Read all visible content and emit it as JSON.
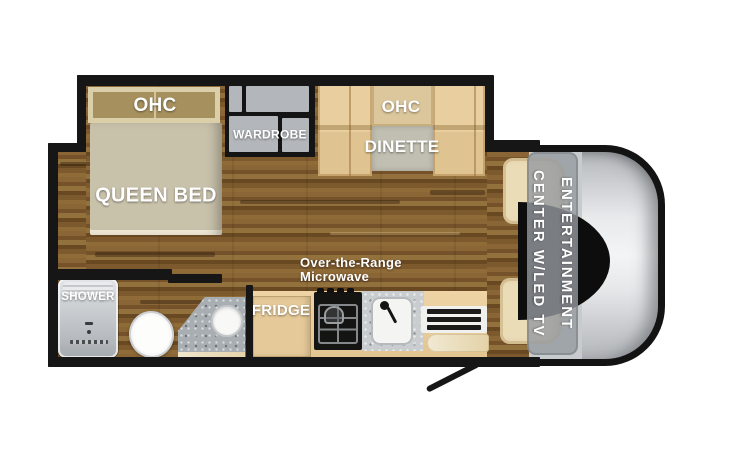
{
  "floorplan": {
    "bedroom": {
      "ohc_label": "OHC",
      "bed_label": "QUEEN BED"
    },
    "wardrobe": {
      "label": "WARDROBE"
    },
    "dinette": {
      "ohc_label": "OHC",
      "table_label": "DINETTE"
    },
    "bathroom": {
      "shower_label": "SHOWER"
    },
    "kitchen": {
      "fridge_label": "FRIDGE",
      "microwave_line1": "Over-the-Range",
      "microwave_line2": "Microwave"
    },
    "cab": {
      "tv_line1": "ENTERTAINMENT",
      "tv_line2": "CENTER W/LED TV"
    },
    "colors": {
      "wall": "#161616",
      "wood_floor": "#7d5a2e",
      "cabinet_tan": "#e9cf9f",
      "counter_tan": "#e8cf9f",
      "bed_fabric": "#c9c2ab",
      "ohc_frame": "#dbcfa9",
      "ohc_inner": "#a6915e",
      "wardrobe_gray": "#b3b7bb",
      "granite_gray": "#a9aeb3",
      "shower_gray": "#cfd2d5",
      "cab_silver": "#e8eaec",
      "seat_cream": "#ebdcb8",
      "tv_band_gray": "#969ba1",
      "label_text": "#ffffff"
    }
  }
}
